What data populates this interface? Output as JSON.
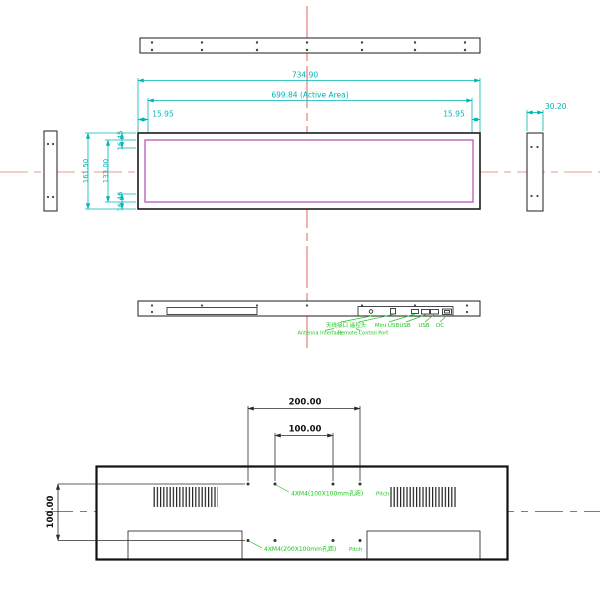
{
  "drawing": {
    "type": "technical-dimension-drawing",
    "views": [
      "top",
      "front",
      "left-side",
      "right-side",
      "bottom-ports",
      "rear-vesa"
    ]
  },
  "dims": {
    "overall_width": "734.90",
    "active_width": "699.84  (Active Area)",
    "bezel_left": "15.95",
    "bezel_right": "15.95",
    "overall_height": "161.50",
    "inner_height": "133.00",
    "bezel_top": "16.45",
    "bezel_bottom": "16.46",
    "depth": "30.20",
    "vesa_width_200": "200.00",
    "vesa_width_100": "100.00",
    "vesa_height_100": "100.00"
  },
  "ports": {
    "antenna_cn": "天线接口",
    "remote_cn": "遥控头",
    "mini_usb": "Mini USB",
    "usb_1": "USB",
    "usb_2": "USB",
    "dc": "DC",
    "antenna_en": "Antenna Interface",
    "remote_en": "Remote Control Port"
  },
  "callouts": {
    "vesa100_text": "4XM4(100X100mm孔距)",
    "vesa100_pitch": "Pitch",
    "vesa200_text": "4XM4(200X100mm孔距)",
    "vesa200_pitch": "Pitch"
  },
  "colors": {
    "dimension_cyan": "#00b5b5",
    "centerline_red": "#e0544a",
    "centerline_pink": "#e89890",
    "active_area_magenta": "#b55ab5",
    "callout_green": "#1dc51d",
    "outline_black": "#1c1c1c"
  }
}
